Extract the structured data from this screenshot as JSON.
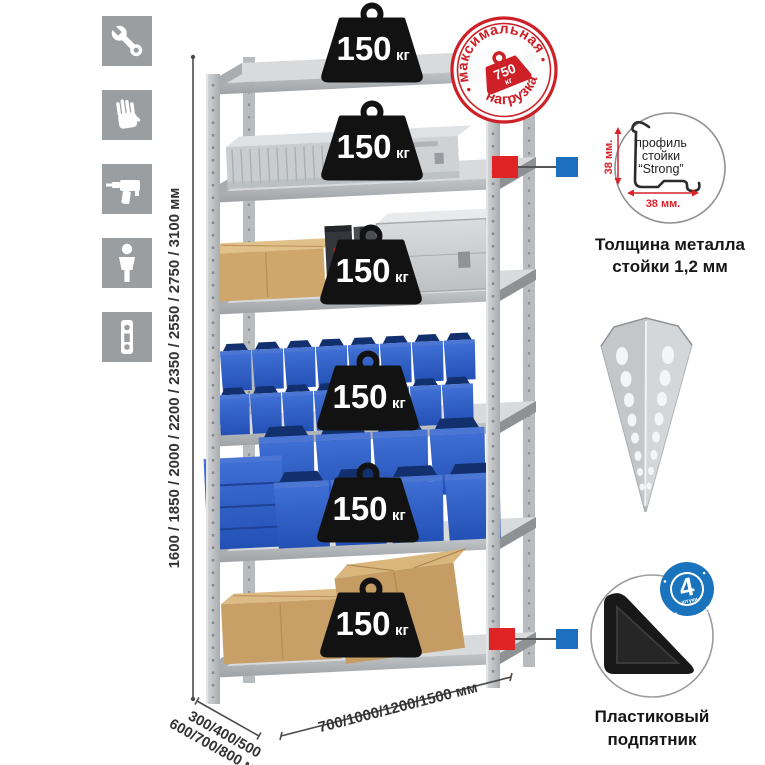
{
  "sidebar_icons": [
    {
      "name": "wrench"
    },
    {
      "name": "gloves"
    },
    {
      "name": "drill"
    },
    {
      "name": "person"
    },
    {
      "name": "perforated-strip"
    }
  ],
  "dimensions": {
    "height_label": "1600 / 1850 / 2000 / 2200 / 2350 / 2550 / 2750 / 3100 мм",
    "depth_line1": "300/400/500",
    "depth_line2": "600/700/800 мм",
    "width_label": "700/1000/1200/1500 мм"
  },
  "shelves": [
    {
      "load_value": "150",
      "load_unit": "кг",
      "contents": "empty-top-shelf"
    },
    {
      "load_value": "150",
      "load_unit": "кг",
      "contents": "aluminum-case"
    },
    {
      "load_value": "150",
      "load_unit": "кг",
      "contents": "cardboard-box-and-cases"
    },
    {
      "load_value": "150",
      "load_unit": "кг",
      "contents": "small-blue-bins"
    },
    {
      "load_value": "150",
      "load_unit": "кг",
      "contents": "large-blue-bins"
    },
    {
      "load_value": "150",
      "load_unit": "кг",
      "contents": "cardboard-boxes"
    }
  ],
  "stamp": {
    "arc_top": "максимальная",
    "arc_bottom": "нагрузка",
    "weight_value": "750",
    "weight_unit": "кг"
  },
  "profile_detail": {
    "line1": "профиль",
    "line2": "стойки",
    "line3": "“Strong”",
    "dim_vertical": "38 мм.",
    "dim_horizontal": "38 мм.",
    "caption_line1": "Толщина металла",
    "caption_line2": "стойки 1,2 мм"
  },
  "foot_detail": {
    "badge_number": "4",
    "badge_word": "штуки",
    "badge_arc": "в комплекте",
    "caption_line1": "Пластиковый",
    "caption_line2": "подпятник"
  },
  "colors": {
    "stamp_red": "#cd2027",
    "bin_blue": "#2e5fc4",
    "connector_red": "#e02325",
    "connector_blue": "#1d6fc0",
    "icon_gray": "#9b9ea1",
    "weight_black": "#121212",
    "metal_light": "#d8dadc",
    "cardboard": "#c89f66"
  }
}
